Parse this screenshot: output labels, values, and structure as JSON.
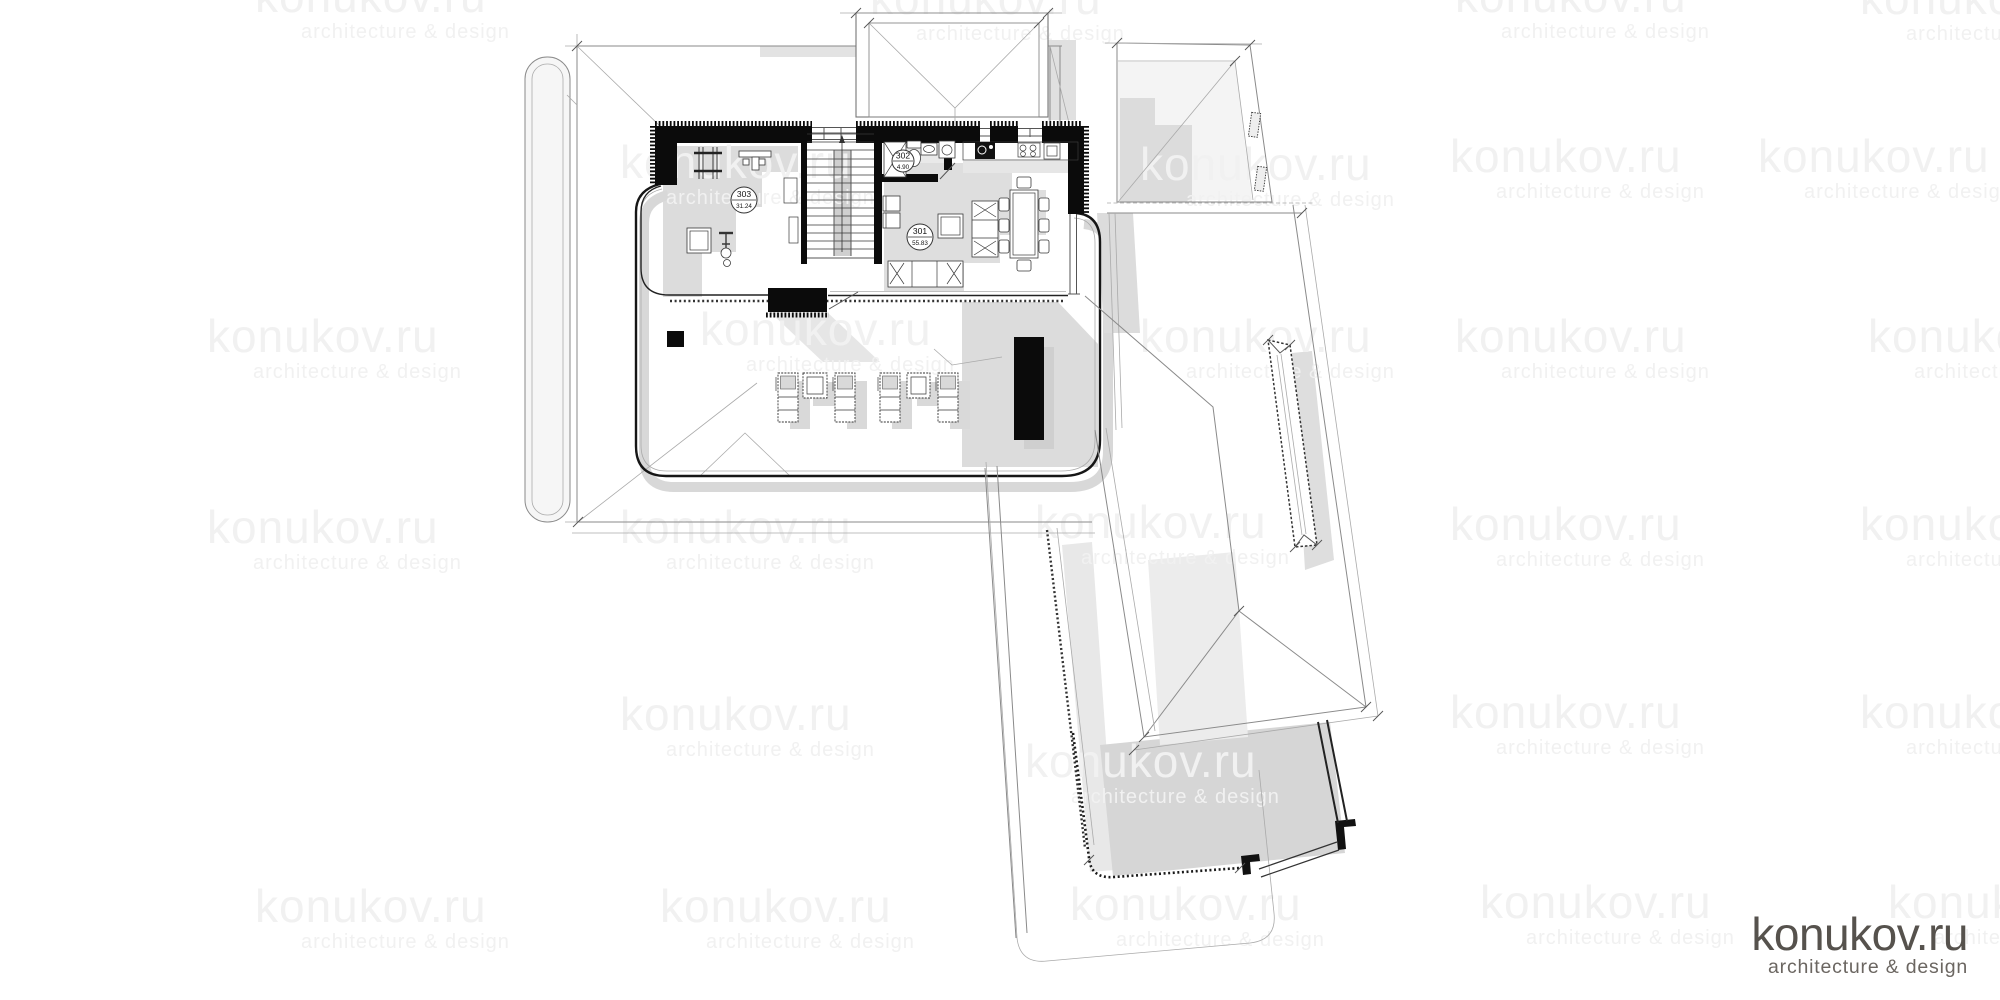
{
  "branding": {
    "logo": {
      "title": "konukov.ru",
      "subtitle": "architecture & design"
    },
    "watermark": {
      "title": "konukov.ru",
      "subtitle": "architecture & design"
    }
  },
  "floor_plan": {
    "rooms": [
      {
        "id": "301",
        "area": "55.83"
      },
      {
        "id": "302",
        "area": "4.90"
      },
      {
        "id": "303",
        "area": "31.24"
      }
    ]
  },
  "colors": {
    "wall": "#0b0b0b",
    "shadow": "#dcdcdc",
    "line": "#8a8a8a",
    "watermark": "#f1f1f1",
    "logo": "#56524d"
  }
}
